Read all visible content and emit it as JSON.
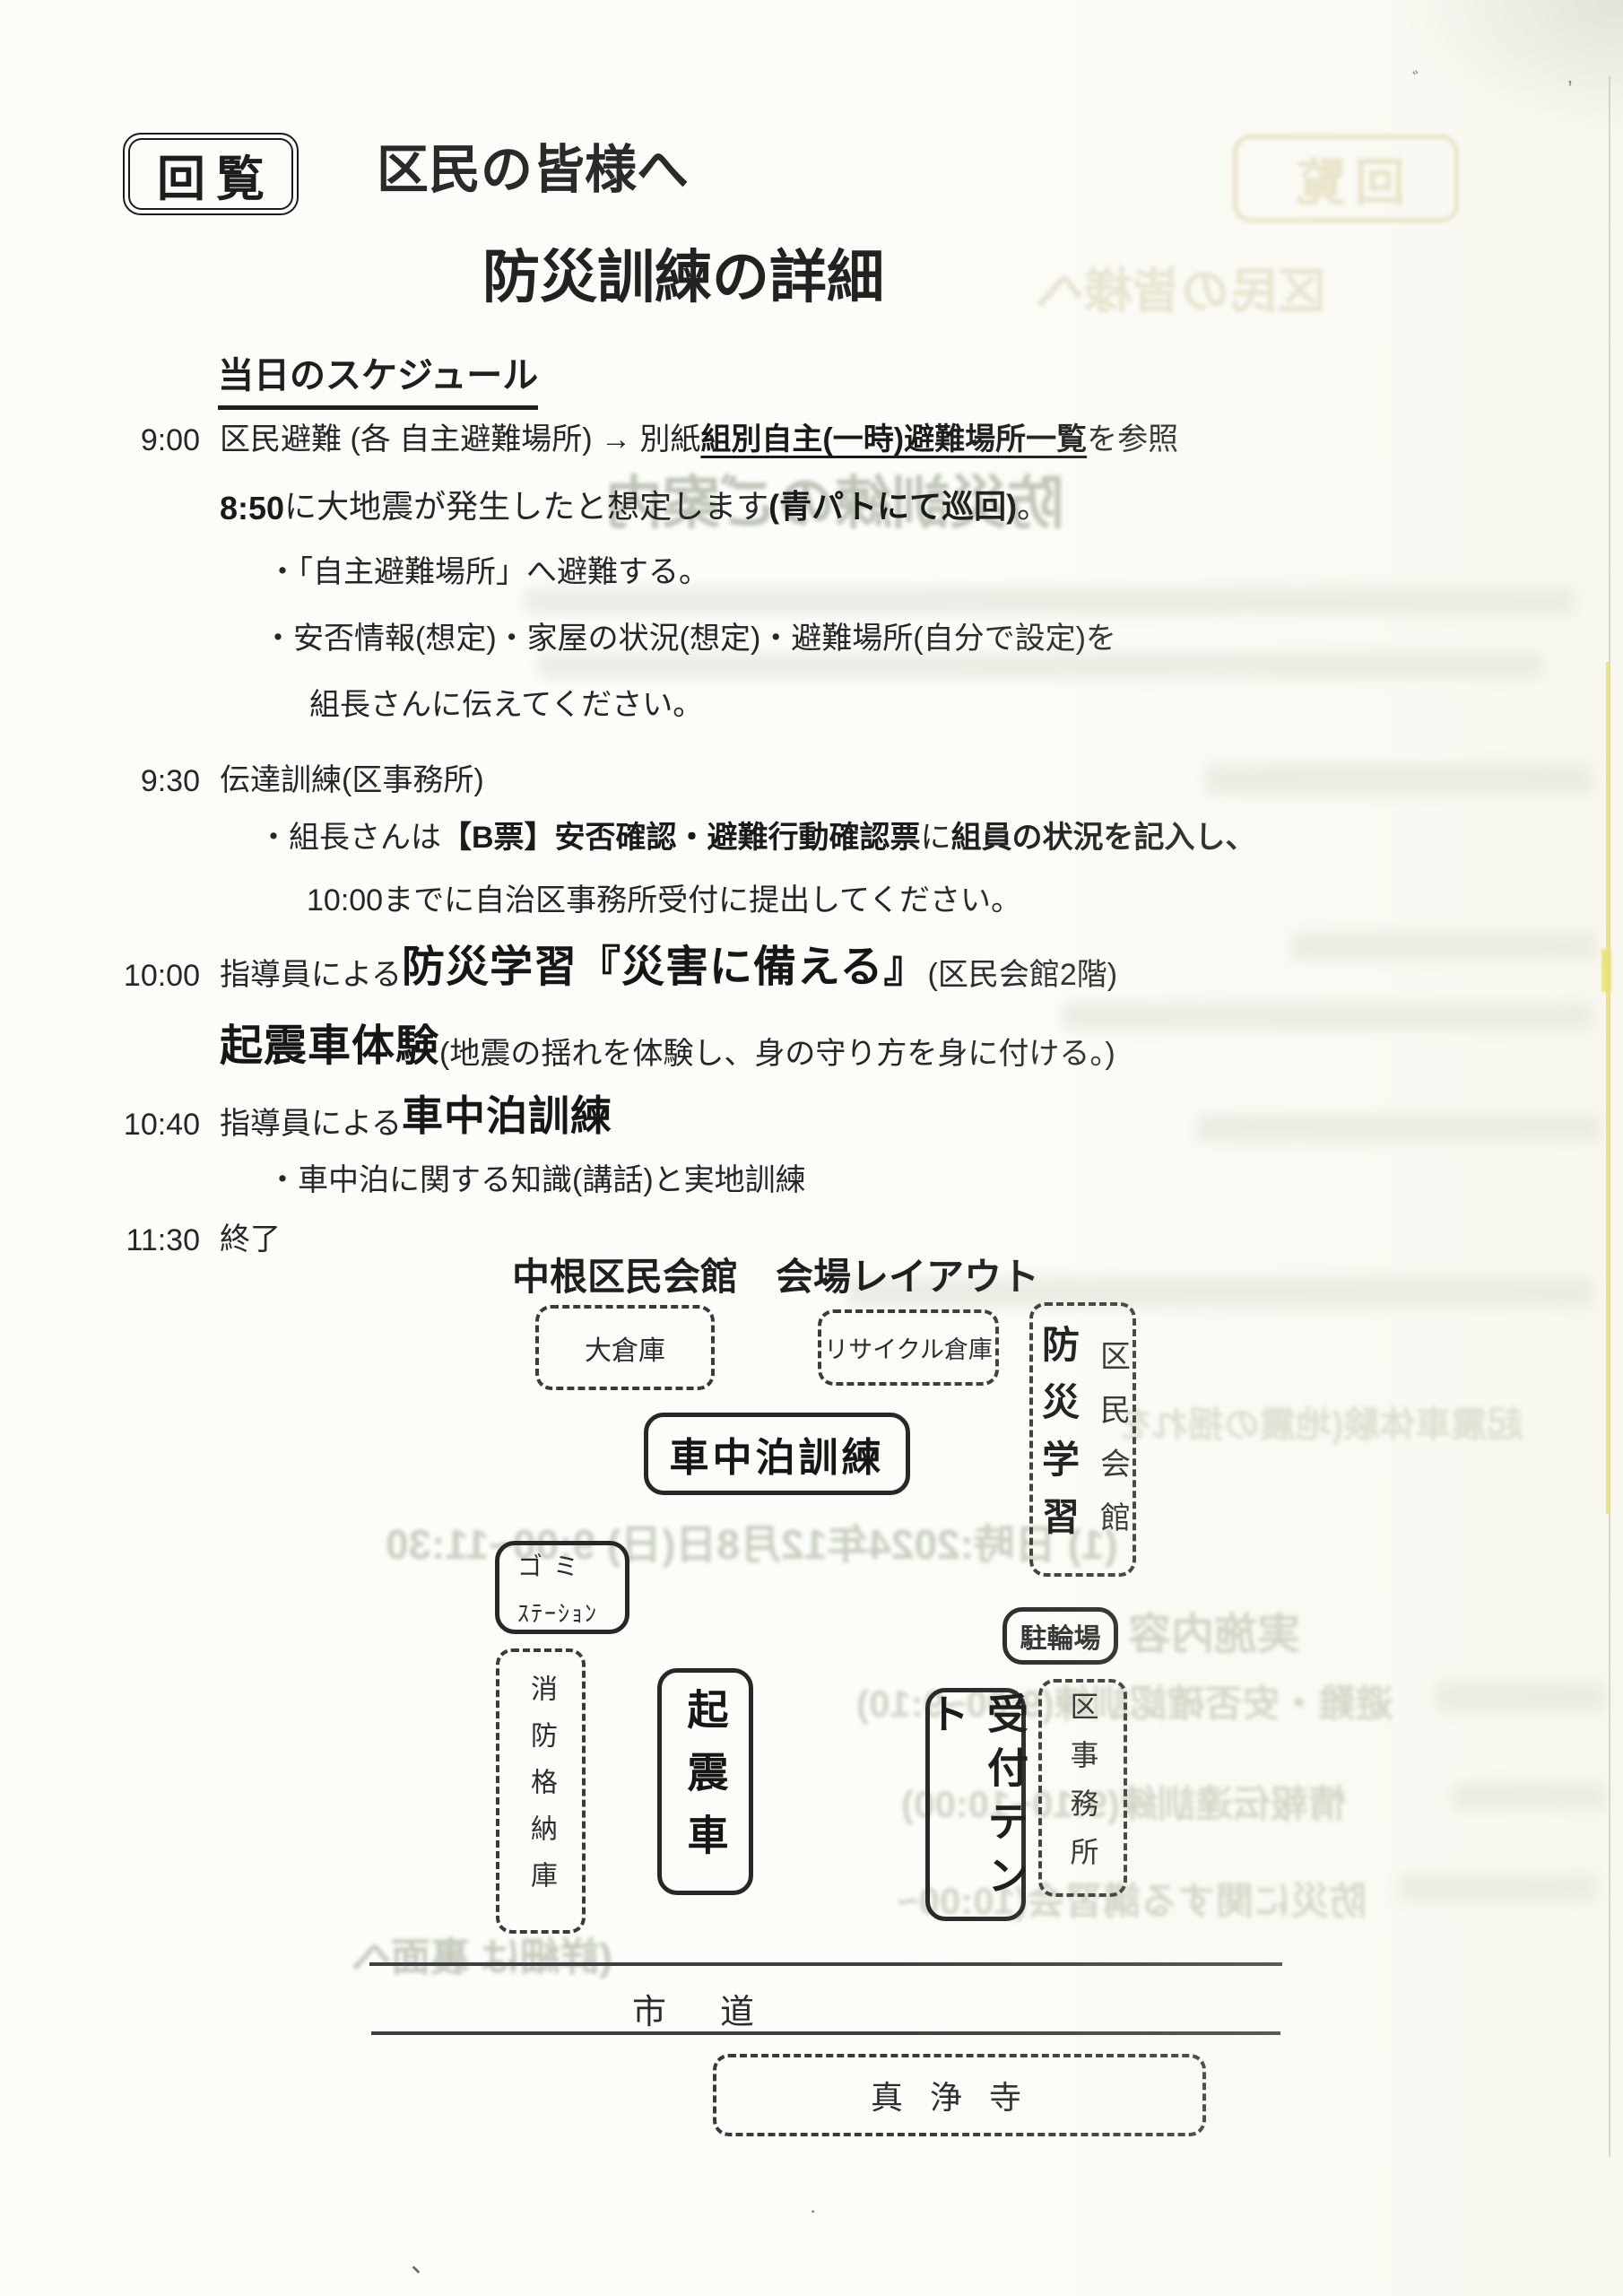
{
  "document": {
    "kairan_stamp": "回覧",
    "heading_to": "区民の皆様へ",
    "heading_title": "防災訓練の詳細",
    "schedule_heading": "当日のスケジュール",
    "schedule_rows": [
      {
        "time": "9:00",
        "segments": [
          {
            "t": "区民避難 (各 自主避難場所) → 別紙 ",
            "s": ""
          },
          {
            "t": "組別自主(一時)避難場所一覧",
            "s": "bu"
          },
          {
            "t": " を参照",
            "s": ""
          }
        ]
      },
      {
        "time": "",
        "segments": [
          {
            "t": "8:50",
            "s": "b"
          },
          {
            "t": "に大地震が発生したと想定します",
            "s": ""
          },
          {
            "t": "(青パトにて巡回)",
            "s": "b"
          },
          {
            "t": "。",
            "s": ""
          }
        ]
      },
      {
        "time": "",
        "segments": [
          {
            "t": "・「自主避難場所」へ避難する。",
            "s": ""
          }
        ]
      },
      {
        "time": "",
        "segments": [
          {
            "t": "・安否情報(想定)・家屋の状況(想定)・避難場所(自分で設定)を",
            "s": ""
          }
        ]
      },
      {
        "time": "",
        "segments": [
          {
            "t": "組長さんに伝えてください。",
            "s": ""
          }
        ]
      },
      {
        "time": "9:30",
        "segments": [
          {
            "t": "伝達訓練(区事務所)",
            "s": ""
          }
        ]
      },
      {
        "time": "",
        "segments": [
          {
            "t": "・組長さんは",
            "s": ""
          },
          {
            "t": "【B票】安否確認・避難行動確認票",
            "s": "b"
          },
          {
            "t": "に",
            "s": ""
          },
          {
            "t": "組員の状況を記入し、",
            "s": "b"
          }
        ]
      },
      {
        "time": "",
        "segments": [
          {
            "t": "10:00までに自治区事務所受付に提出してください。",
            "s": ""
          }
        ]
      },
      {
        "time": "10:00",
        "segments": [
          {
            "t": "指導員による",
            "s": ""
          },
          {
            "t": "防災学習『災害に備える』",
            "s": "big"
          },
          {
            "t": " (区民会館2階)",
            "s": ""
          }
        ]
      },
      {
        "time": "",
        "segments": [
          {
            "t": "起震車体験",
            "s": "big"
          },
          {
            "t": " (地震の揺れを体験し、身の守り方を身に付ける。)",
            "s": ""
          }
        ]
      },
      {
        "time": "10:40",
        "segments": [
          {
            "t": "指導員による",
            "s": ""
          },
          {
            "t": "車中泊訓練",
            "s": "big2"
          }
        ]
      },
      {
        "time": "",
        "segments": [
          {
            "t": "・車中泊に関する知識(講話)と実地訓練",
            "s": ""
          }
        ]
      },
      {
        "time": "11:30",
        "segments": [
          {
            "t": "終了",
            "s": ""
          }
        ]
      }
    ]
  },
  "layout_diagram": {
    "title": "中根区民会館　会場レイアウト",
    "boxes": [
      {
        "id": "okura",
        "label": "大倉庫"
      },
      {
        "id": "recycle",
        "label": "リサイクル倉庫"
      },
      {
        "id": "bosai",
        "label": "防災学習",
        "label2": "区民会館"
      },
      {
        "id": "shachuhaku",
        "label": "車中泊訓練"
      },
      {
        "id": "gomi",
        "label": "ゴミ",
        "label2": "ｽﾃｰｼｮﾝ"
      },
      {
        "id": "churinjo",
        "label": "駐輪場"
      },
      {
        "id": "shobo",
        "label": "消防格納庫"
      },
      {
        "id": "kishinsha",
        "label": "起震車"
      },
      {
        "id": "uketsuke",
        "label": "受付テント"
      },
      {
        "id": "kujimusho",
        "label": "区事務所"
      },
      {
        "id": "shinjoji",
        "label": "真浄寺"
      }
    ],
    "road_label": "市道"
  },
  "bleedthrough": {
    "items": [
      {
        "id": "g-kairan",
        "text": "回覧"
      },
      {
        "id": "g-heading",
        "text": "区民の皆様へ"
      },
      {
        "id": "g-title",
        "text": "防災訓練のご案内"
      },
      {
        "id": "g-taiken",
        "text": "起震車体験(地震の揺れを"
      },
      {
        "id": "g-date",
        "text": "(1) 日時:2024年12月8日(日) 9:00~11:30"
      },
      {
        "id": "g-naiyo",
        "text": "実施内容"
      },
      {
        "id": "g-s1",
        "text": "避難・安否確認訓練(9:00~9:10)"
      },
      {
        "id": "g-s2",
        "text": "情報伝達訓練(9:10~10:00)"
      },
      {
        "id": "g-s3",
        "text": "防災に関する講習会(10:00~"
      },
      {
        "id": "g-back",
        "text": "(詳細は 裏面へ"
      }
    ]
  },
  "artifact_colors": {
    "highlighter_yellow": "#e6dd4f",
    "scan_edge_gray": "#a9a9a4",
    "ghost_green": "#b7c1ac"
  }
}
